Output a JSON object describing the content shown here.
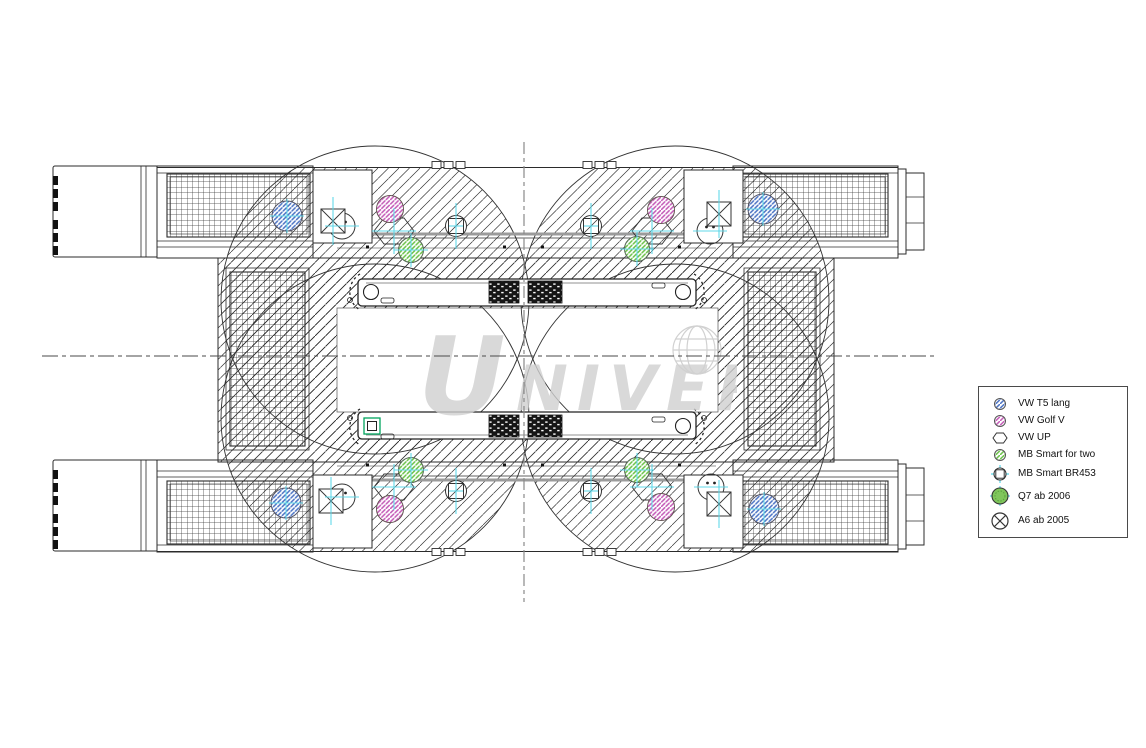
{
  "watermark": {
    "letter_first": "U",
    "letters_rest": "NIVERSAL"
  },
  "legend": {
    "items": [
      {
        "id": "vw-t5",
        "label": "VW T5 lang",
        "symbol": "circle-hatch-blue"
      },
      {
        "id": "vw-golf-v",
        "label": "VW Golf V",
        "symbol": "circle-hatch-pink"
      },
      {
        "id": "vw-up",
        "label": "VW UP",
        "symbol": "hexagon-outline"
      },
      {
        "id": "mb-smart-fortwo",
        "label": "MB Smart for two",
        "symbol": "circle-hatch-green"
      },
      {
        "id": "mb-smart-br453",
        "label": "MB Smart BR453",
        "symbol": "circle-square-crosshair"
      },
      {
        "id": "q7-ab-2006",
        "label": "Q7 ab 2006",
        "symbol": "circle-solid-green-crosshair"
      },
      {
        "id": "a6-ab-2005",
        "label": "A6 ab 2005",
        "symbol": "circle-x"
      }
    ]
  },
  "drawing": {
    "colors": {
      "line": "#2b2b2b",
      "hatch_blue": "#4d74c4",
      "hatch_pink": "#c45cb8",
      "hatch_green": "#6cc24a",
      "q7_green": "#7fc65c",
      "crosshair_cyan": "#5ad6e8",
      "detail_teal": "#00a55e",
      "watermark_gray": "#d0d0d0"
    },
    "symbols": [
      {
        "type": "hex",
        "name": "symbol-vw-up-hexagon",
        "x": 394,
        "y": 231
      },
      {
        "type": "hex",
        "name": "symbol-vw-up-hexagon",
        "x": 652,
        "y": 231
      },
      {
        "type": "hex",
        "name": "symbol-vw-up-hexagon",
        "x": 394,
        "y": 487
      },
      {
        "type": "hex",
        "name": "symbol-vw-up-hexagon",
        "x": 652,
        "y": 487
      },
      {
        "type": "circ",
        "name": "symbol-plain-circle",
        "x": 342,
        "y": 226
      },
      {
        "type": "circ",
        "name": "symbol-plain-circle",
        "x": 710,
        "y": 231
      },
      {
        "type": "circ",
        "name": "symbol-plain-circle",
        "x": 342,
        "y": 497
      },
      {
        "type": "circ",
        "name": "symbol-plain-circle",
        "x": 711,
        "y": 487
      },
      {
        "type": "xsq",
        "name": "symbol-x-square",
        "x": 333,
        "y": 221
      },
      {
        "type": "xsq",
        "name": "symbol-x-square",
        "x": 719,
        "y": 214
      },
      {
        "type": "xsq",
        "name": "symbol-x-square",
        "x": 331,
        "y": 501
      },
      {
        "type": "xsq",
        "name": "symbol-x-square",
        "x": 719,
        "y": 504
      },
      {
        "type": "green",
        "name": "symbol-mb-smart-fortwo",
        "x": 411,
        "y": 250
      },
      {
        "type": "green",
        "name": "symbol-mb-smart-fortwo",
        "x": 637,
        "y": 249
      },
      {
        "type": "green",
        "name": "symbol-mb-smart-fortwo",
        "x": 411,
        "y": 470
      },
      {
        "type": "green",
        "name": "symbol-mb-smart-fortwo",
        "x": 637,
        "y": 470
      },
      {
        "type": "pink",
        "name": "symbol-vw-golf-wheel",
        "x": 390,
        "y": 209
      },
      {
        "type": "pink",
        "name": "symbol-vw-golf-wheel",
        "x": 661,
        "y": 210
      },
      {
        "type": "pink",
        "name": "symbol-vw-golf-wheel",
        "x": 390,
        "y": 509
      },
      {
        "type": "pink",
        "name": "symbol-vw-golf-wheel",
        "x": 661,
        "y": 507
      },
      {
        "type": "br453",
        "name": "symbol-mb-smart-br453",
        "x": 456,
        "y": 226
      },
      {
        "type": "br453",
        "name": "symbol-mb-smart-br453",
        "x": 591,
        "y": 226
      },
      {
        "type": "br453",
        "name": "symbol-mb-smart-br453",
        "x": 456,
        "y": 491
      },
      {
        "type": "br453",
        "name": "symbol-mb-smart-br453",
        "x": 591,
        "y": 491
      },
      {
        "type": "blue",
        "name": "symbol-vw-t5-wheel",
        "x": 287,
        "y": 216
      },
      {
        "type": "blue",
        "name": "symbol-vw-t5-wheel",
        "x": 763,
        "y": 209
      },
      {
        "type": "blue",
        "name": "symbol-vw-t5-wheel",
        "x": 286,
        "y": 503
      },
      {
        "type": "blue",
        "name": "symbol-vw-t5-wheel",
        "x": 764,
        "y": 509
      }
    ],
    "crosshairs": [
      {
        "x": 456,
        "y": 226,
        "v": 46,
        "h": 14
      },
      {
        "x": 591,
        "y": 226,
        "v": 46,
        "h": 14
      },
      {
        "x": 456,
        "y": 491,
        "v": 46,
        "h": 14
      },
      {
        "x": 591,
        "y": 491,
        "v": 46,
        "h": 14
      },
      {
        "x": 333,
        "y": 221,
        "v": 48,
        "h": 0
      },
      {
        "x": 719,
        "y": 214,
        "v": 48,
        "h": 0
      },
      {
        "x": 331,
        "y": 501,
        "v": 48,
        "h": 0
      },
      {
        "x": 719,
        "y": 504,
        "v": 48,
        "h": 0
      },
      {
        "x": 394,
        "y": 231,
        "v": 46,
        "h": 44
      },
      {
        "x": 652,
        "y": 231,
        "v": 46,
        "h": 44
      },
      {
        "x": 394,
        "y": 487,
        "v": 46,
        "h": 44
      },
      {
        "x": 652,
        "y": 487,
        "v": 46,
        "h": 44
      },
      {
        "x": 411,
        "y": 250,
        "v": 34,
        "h": 34
      },
      {
        "x": 637,
        "y": 249,
        "v": 34,
        "h": 34
      },
      {
        "x": 411,
        "y": 470,
        "v": 34,
        "h": 34
      },
      {
        "x": 637,
        "y": 470,
        "v": 34,
        "h": 34
      },
      {
        "x": 287,
        "y": 216,
        "v": 34,
        "h": 34
      },
      {
        "x": 763,
        "y": 209,
        "v": 34,
        "h": 34
      },
      {
        "x": 286,
        "y": 503,
        "v": 34,
        "h": 34
      },
      {
        "x": 764,
        "y": 509,
        "v": 34,
        "h": 34
      },
      {
        "x": 342,
        "y": 226,
        "v": 0,
        "h": 34
      },
      {
        "x": 710,
        "y": 231,
        "v": 0,
        "h": 34
      },
      {
        "x": 342,
        "y": 497,
        "v": 0,
        "h": 34
      },
      {
        "x": 711,
        "y": 487,
        "v": 0,
        "h": 34
      }
    ]
  }
}
